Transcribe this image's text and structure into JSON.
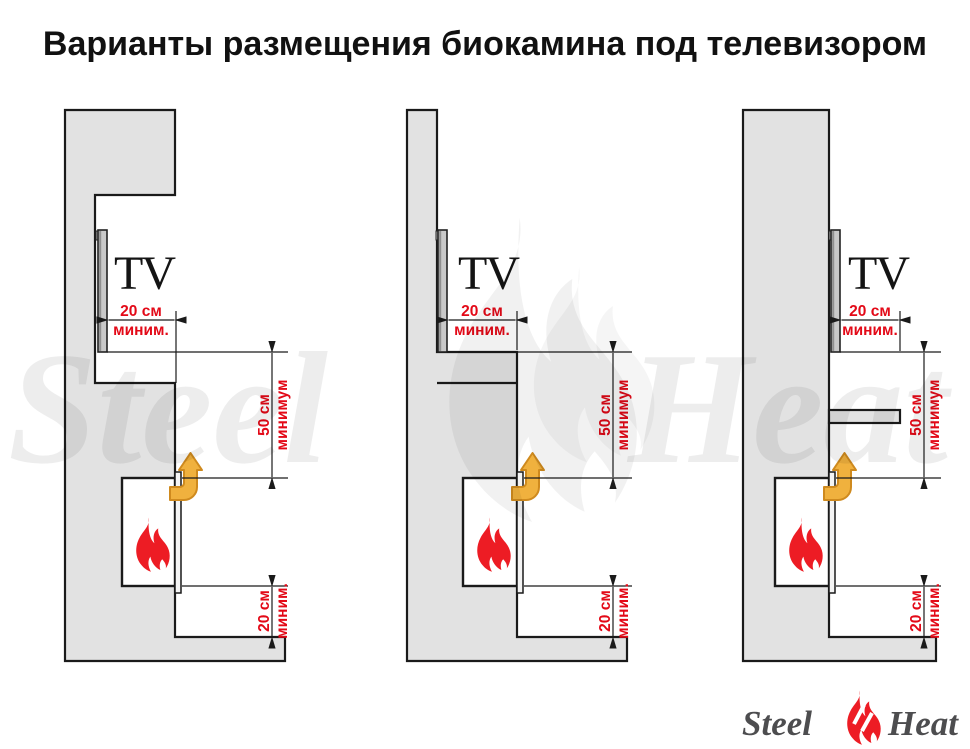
{
  "title": "Варианты размещения биокамина под телевизором",
  "tv_label": "TV",
  "dims": {
    "side": {
      "line1": "20 см",
      "line2": "миним."
    },
    "vertical50": {
      "line1": "50 см",
      "line2": "минимум"
    },
    "bottom20": {
      "line1": "20 см",
      "line2": "миним."
    }
  },
  "watermark": {
    "steel": "Steel",
    "heat": "Heat"
  },
  "logo": {
    "steel": "Steel",
    "heat": "Heat"
  },
  "colors": {
    "dimension_red": "#e30917",
    "flame_red": "#ed1c24",
    "arrow_orange_fill": "#f0b13e",
    "arrow_orange_stroke": "#cf8a1e",
    "wall_gray": "#e2e2e2",
    "outline_black": "#1a1a1a",
    "logo_gray": "#4d4d4f"
  }
}
